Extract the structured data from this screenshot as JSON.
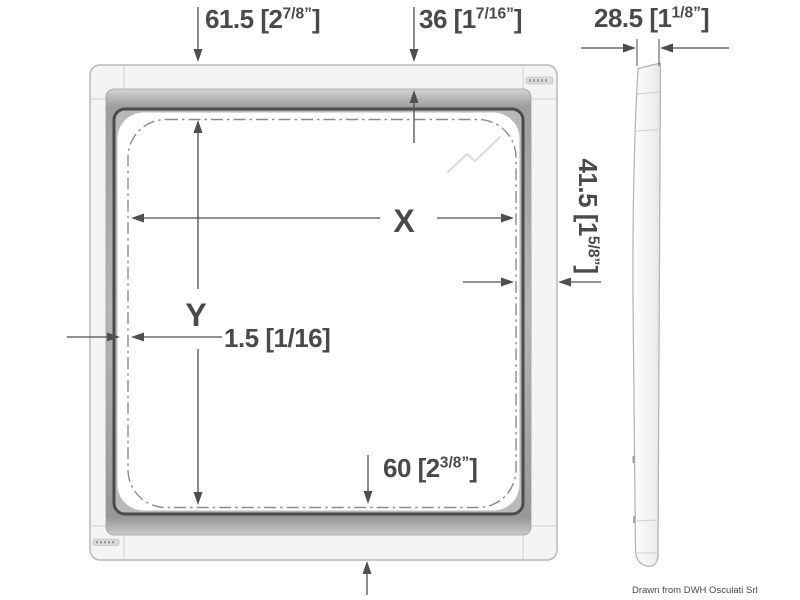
{
  "credit": "Drawn from DWH Osculati Srl",
  "dims": {
    "d615": {
      "pre": "61.5 [2",
      "sup": "7/8”",
      "post": "]"
    },
    "d36": {
      "pre": "36 [1",
      "sup": "7/16”",
      "post": "]"
    },
    "d285": {
      "pre": "28.5 [1",
      "sup": "1/8”",
      "post": "]"
    },
    "d415": {
      "pre": "41.5 [1",
      "sup": "5/8”",
      "post": "]"
    },
    "d60": {
      "pre": "60 [2",
      "sup": "3/8”",
      "post": "]"
    },
    "d15": "1.5 [1/16]",
    "x": "X",
    "y": "Y"
  },
  "colors": {
    "text": "#4a4a4a",
    "line": "#4f4f4f",
    "frame-light": "#f4f4f4",
    "frame-gray": "#b4b4b4",
    "frame-dark": "#4b4b4b",
    "dash-line": "#8d8d8d"
  }
}
